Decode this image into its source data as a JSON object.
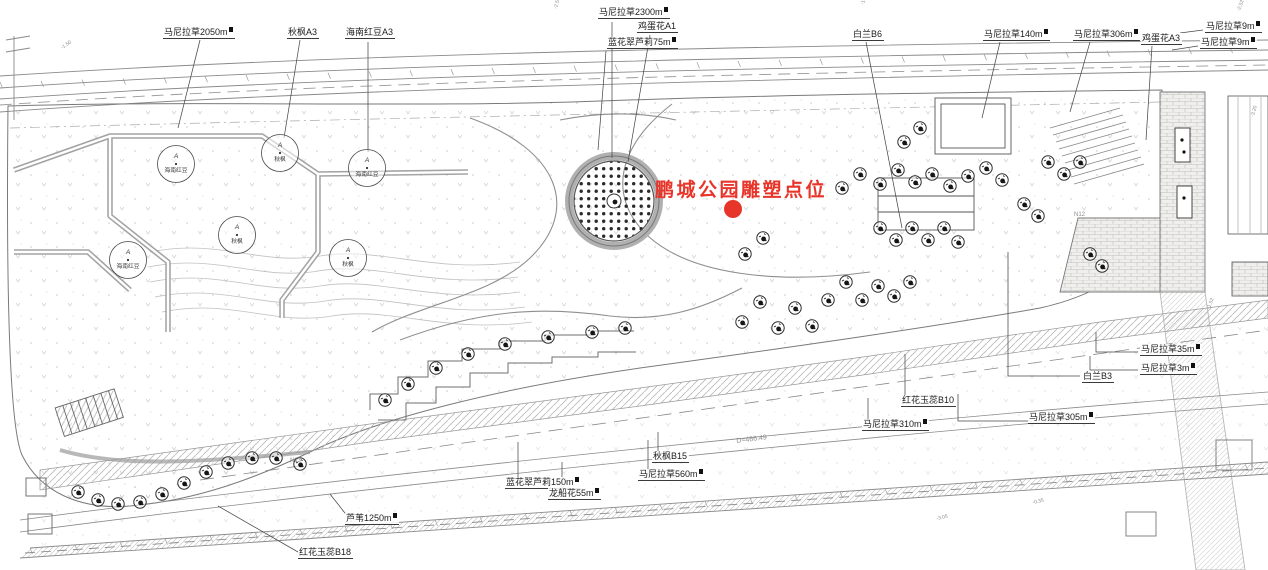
{
  "annotation": {
    "text": "鹏城公园雕塑点位",
    "color": "#e8352a",
    "dot": {
      "x": 733,
      "y": 209,
      "r": 9
    }
  },
  "labels": [
    {
      "text": "马尼拉草2050m",
      "sup": true,
      "x": 163,
      "y": 27,
      "leader": [
        [
          200,
          40
        ],
        [
          178,
          128
        ]
      ]
    },
    {
      "text": "秋枫A3",
      "sup": false,
      "x": 287,
      "y": 27,
      "leader": [
        [
          300,
          40
        ],
        [
          284,
          138
        ]
      ]
    },
    {
      "text": "海南红豆A3",
      "sup": false,
      "x": 345,
      "y": 27,
      "leader": [
        [
          368,
          42
        ],
        [
          368,
          152
        ]
      ]
    },
    {
      "text": "马尼拉草2300m",
      "sup": true,
      "x": 598,
      "y": 7,
      "leader": [
        [
          612,
          22
        ],
        [
          612,
          158
        ]
      ]
    },
    {
      "text": "鸡蛋花A1",
      "sup": false,
      "x": 637,
      "y": 21,
      "leader": [
        [
          650,
          35
        ],
        [
          628,
          162
        ]
      ]
    },
    {
      "text": "蓝花翠芦莉75m",
      "sup": true,
      "x": 607,
      "y": 37,
      "leader": [
        [
          606,
          51
        ],
        [
          598,
          150
        ]
      ]
    },
    {
      "text": "白兰B6",
      "sup": false,
      "x": 852,
      "y": 29,
      "leader": [
        [
          866,
          42
        ],
        [
          902,
          228
        ]
      ]
    },
    {
      "text": "马尼拉草140m",
      "sup": true,
      "x": 983,
      "y": 29,
      "leader": [
        [
          1000,
          42
        ],
        [
          982,
          118
        ]
      ]
    },
    {
      "text": "马尼拉草306m",
      "sup": true,
      "x": 1073,
      "y": 29,
      "leader": [
        [
          1090,
          42
        ],
        [
          1070,
          112
        ]
      ]
    },
    {
      "text": "鸡蛋花A3",
      "sup": false,
      "x": 1141,
      "y": 33,
      "leader": [
        [
          1152,
          46
        ],
        [
          1146,
          140
        ]
      ]
    },
    {
      "text": "马尼拉草9m",
      "sup": true,
      "x": 1205,
      "y": 21,
      "leader": [
        [
          1203,
          30
        ],
        [
          1180,
          33
        ]
      ]
    },
    {
      "text": "马尼拉草9m",
      "sup": true,
      "x": 1200,
      "y": 37,
      "leader": [
        [
          1198,
          46
        ],
        [
          1172,
          50
        ]
      ]
    },
    {
      "text": "马尼拉草35m",
      "sup": true,
      "x": 1140,
      "y": 344,
      "leader": [
        [
          1138,
          352
        ],
        [
          1096,
          352
        ],
        [
          1096,
          332
        ]
      ]
    },
    {
      "text": "马尼拉草3m",
      "sup": true,
      "x": 1140,
      "y": 363,
      "leader": [
        [
          1138,
          370
        ],
        [
          1090,
          370
        ],
        [
          1090,
          356
        ]
      ]
    },
    {
      "text": "白兰B3",
      "sup": false,
      "x": 1082,
      "y": 371,
      "leader": [
        [
          1080,
          376
        ],
        [
          1008,
          376
        ],
        [
          1008,
          252
        ]
      ]
    },
    {
      "text": "马尼拉草305m",
      "sup": true,
      "x": 1028,
      "y": 412,
      "leader": [
        [
          1032,
          421
        ],
        [
          958,
          421
        ],
        [
          958,
          394
        ]
      ]
    },
    {
      "text": "马尼拉草310m",
      "sup": true,
      "x": 862,
      "y": 419,
      "leader": [
        [
          868,
          428
        ],
        [
          868,
          398
        ]
      ]
    },
    {
      "text": "红花玉蕊B10",
      "sup": false,
      "x": 901,
      "y": 395,
      "leader": [
        [
          905,
          404
        ],
        [
          905,
          354
        ]
      ]
    },
    {
      "text": "秋枫B15",
      "sup": false,
      "x": 652,
      "y": 451,
      "leader": [
        [
          658,
          460
        ],
        [
          658,
          432
        ]
      ]
    },
    {
      "text": "马尼拉草560m",
      "sup": true,
      "x": 638,
      "y": 469,
      "leader": [
        [
          648,
          478
        ],
        [
          648,
          440
        ]
      ]
    },
    {
      "text": "蓝花翠芦莉150m",
      "sup": true,
      "x": 505,
      "y": 477,
      "leader": [
        [
          518,
          486
        ],
        [
          518,
          442
        ]
      ]
    },
    {
      "text": "龙船花55m",
      "sup": true,
      "x": 548,
      "y": 488,
      "leader": [
        [
          562,
          497
        ],
        [
          562,
          462
        ]
      ]
    },
    {
      "text": "芦苇1250m",
      "sup": true,
      "x": 345,
      "y": 513,
      "leader": [
        [
          352,
          522
        ],
        [
          330,
          494
        ]
      ]
    },
    {
      "text": "红花玉蕊B18",
      "sup": false,
      "x": 298,
      "y": 547,
      "leader": [
        [
          298,
          552
        ],
        [
          218,
          506
        ]
      ]
    }
  ],
  "circle_trees": [
    {
      "letter": "A",
      "name": "海南红豆",
      "x": 176,
      "y": 164
    },
    {
      "letter": "A",
      "name": "秋枫",
      "x": 280,
      "y": 153
    },
    {
      "letter": "A",
      "name": "海南红豆",
      "x": 367,
      "y": 168
    },
    {
      "letter": "A",
      "name": "秋枫",
      "x": 237,
      "y": 235
    },
    {
      "letter": "A",
      "name": "海南红豆",
      "x": 128,
      "y": 260
    },
    {
      "letter": "A",
      "name": "秋枫",
      "x": 348,
      "y": 258
    }
  ],
  "trees": [
    [
      742,
      322
    ],
    [
      760,
      302
    ],
    [
      778,
      328
    ],
    [
      795,
      308
    ],
    [
      812,
      326
    ],
    [
      745,
      254
    ],
    [
      763,
      238
    ],
    [
      828,
      300
    ],
    [
      846,
      282
    ],
    [
      862,
      300
    ],
    [
      878,
      286
    ],
    [
      894,
      296
    ],
    [
      910,
      282
    ],
    [
      842,
      188
    ],
    [
      860,
      174
    ],
    [
      880,
      184
    ],
    [
      898,
      170
    ],
    [
      915,
      182
    ],
    [
      932,
      174
    ],
    [
      950,
      186
    ],
    [
      968,
      176
    ],
    [
      986,
      168
    ],
    [
      1002,
      180
    ],
    [
      880,
      228
    ],
    [
      896,
      240
    ],
    [
      912,
      228
    ],
    [
      928,
      240
    ],
    [
      944,
      228
    ],
    [
      958,
      242
    ],
    [
      1048,
      162
    ],
    [
      1064,
      174
    ],
    [
      1080,
      162
    ],
    [
      1024,
      204
    ],
    [
      1038,
      216
    ],
    [
      920,
      128
    ],
    [
      904,
      142
    ],
    [
      1090,
      254
    ],
    [
      1102,
      266
    ],
    [
      385,
      400
    ],
    [
      408,
      384
    ],
    [
      436,
      368
    ],
    [
      468,
      354
    ],
    [
      505,
      344
    ],
    [
      548,
      337
    ],
    [
      592,
      332
    ],
    [
      625,
      328
    ],
    [
      78,
      492
    ],
    [
      98,
      500
    ],
    [
      118,
      504
    ],
    [
      140,
      502
    ],
    [
      162,
      494
    ],
    [
      184,
      483
    ],
    [
      206,
      472
    ],
    [
      228,
      463
    ],
    [
      252,
      458
    ],
    [
      276,
      458
    ],
    [
      300,
      464
    ]
  ],
  "misc_texts": [
    {
      "text": "D=466.49",
      "x": 736,
      "y": 438,
      "rot": -7,
      "size": 7
    },
    {
      "text": "-1.50",
      "x": 60,
      "y": 46,
      "rot": -35,
      "size": 5
    },
    {
      "text": "-2.50",
      "x": 553,
      "y": 8,
      "rot": -75,
      "size": 5
    },
    {
      "text": "-1.50",
      "x": 860,
      "y": 4,
      "rot": -75,
      "size": 5
    },
    {
      "text": "-2.52",
      "x": 1236,
      "y": 10,
      "rot": -70,
      "size": 5
    },
    {
      "text": "-3.20",
      "x": 1250,
      "y": 116,
      "rot": -75,
      "size": 5
    },
    {
      "text": "-1.52",
      "x": 1206,
      "y": 308,
      "rot": -70,
      "size": 5
    },
    {
      "text": "-3.05",
      "x": 936,
      "y": 516,
      "rot": -12,
      "size": 5
    },
    {
      "text": "-0.35",
      "x": 1032,
      "y": 500,
      "rot": -12,
      "size": 5
    },
    {
      "text": "N13",
      "x": 290,
      "y": 458,
      "rot": 0,
      "size": 6
    },
    {
      "text": "N12",
      "x": 1074,
      "y": 212,
      "rot": 0,
      "size": 6
    }
  ],
  "colors": {
    "line": "#6e6e6e",
    "light_line": "#b5b5b5",
    "leader": "#4a4a4a",
    "annotation_red": "#e8352a"
  }
}
